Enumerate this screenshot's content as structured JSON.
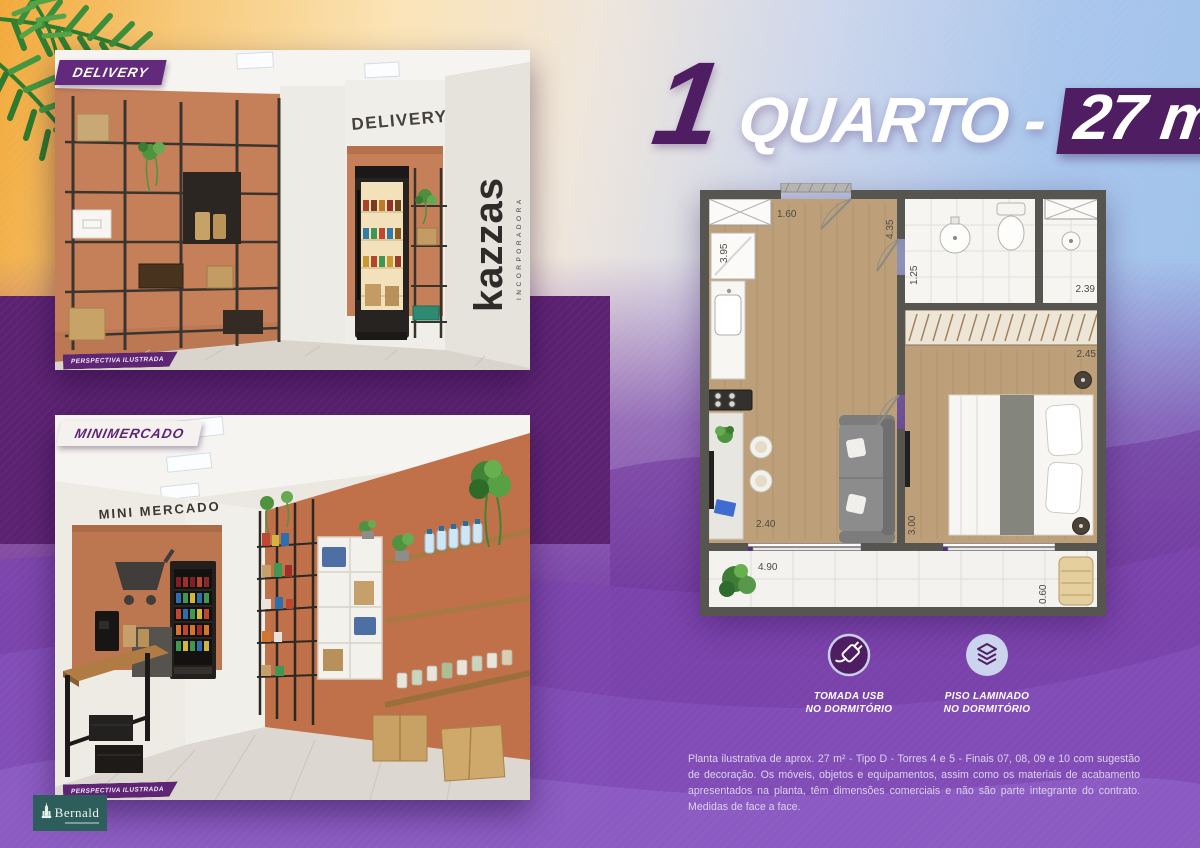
{
  "colors": {
    "brand_purple_dark": "#4f1d62",
    "background_purple": "#7b44a8",
    "tag_purple": "#63297d",
    "logo_teal": "#2d5e5b",
    "terracotta": "#c5805a"
  },
  "title": {
    "number": "1",
    "label": "QUARTO -",
    "area": "27 m",
    "area_sup": "2"
  },
  "photos": {
    "delivery": {
      "tag": "DELIVERY",
      "wall_sign": "DELIVERY",
      "brand_vertical": "kazzas",
      "brand_vertical_sub": "INCORPORADORA",
      "caption": "PERSPECTIVA ILUSTRADA"
    },
    "minimercado": {
      "tag": "MINIMERCADO",
      "wall_sign": "MINI MERCADO",
      "caption": "PERSPECTIVA ILUSTRADA"
    }
  },
  "floorplan": {
    "dims": [
      "1.60",
      "4.35",
      "3.95",
      "1.25",
      "2.39",
      "2.45",
      "2.40",
      "3.00",
      "4.90",
      "0.60"
    ]
  },
  "features": [
    {
      "icon": "usb-plug",
      "line1": "TOMADA USB",
      "line2": "NO DORMITÓRIO"
    },
    {
      "icon": "laminate-floor",
      "line1": "PISO LAMINADO",
      "line2": "NO DORMITÓRIO"
    }
  ],
  "disclaimer": "Planta ilustrativa de aprox. 27 m² - Tipo D - Torres 4 e 5 -  Finais 07, 08, 09 e 10 com sugestão de decoração. Os móveis, objetos e equipamentos, assim como os materiais de acabamento apresentados na planta, têm dimensões comerciais e não são parte integrante do contrato. Medidas de face a face.",
  "logo": {
    "name": "Bernald"
  }
}
